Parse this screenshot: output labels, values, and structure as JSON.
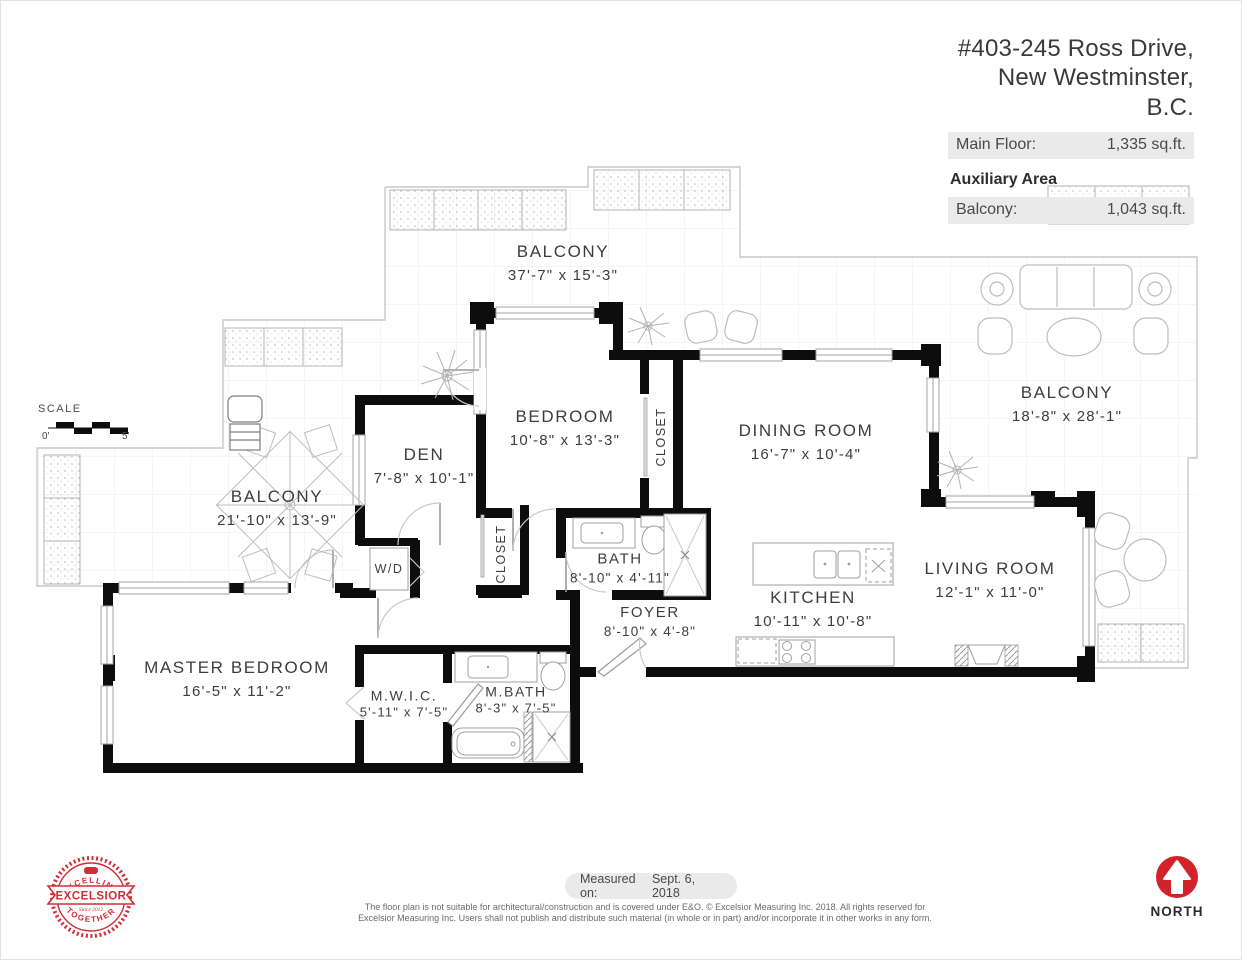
{
  "header": {
    "address_line1": "#403-245 Ross Drive,",
    "address_line2": "New Westminster, B.C.",
    "main_floor_label": "Main Floor:",
    "main_floor_value": "1,335 sq.ft.",
    "auxiliary_title": "Auxiliary Area",
    "balcony_label": "Balcony:",
    "balcony_value": "1,043 sq.ft."
  },
  "scale": {
    "label": "SCALE",
    "start": "0'",
    "end": "5'"
  },
  "rooms": {
    "balcony_top": {
      "name": "BALCONY",
      "dims": "37'-7\" x  15'-3\""
    },
    "bedroom": {
      "name": "BEDROOM",
      "dims": "10'-8\" x  13'-3\""
    },
    "den": {
      "name": "DEN",
      "dims": "7'-8\"  x  10'-1\""
    },
    "dining": {
      "name": "DINING ROOM",
      "dims": "16'-7\" x  10'-4\""
    },
    "balcony_right": {
      "name": "BALCONY",
      "dims": "18'-8\" x  28'-1\""
    },
    "balcony_left": {
      "name": "BALCONY",
      "dims": "21'-10\" x  13'-9\""
    },
    "living": {
      "name": "LIVING ROOM",
      "dims": "12'-1\" x  11'-0\""
    },
    "kitchen": {
      "name": "KITCHEN",
      "dims": "10'-11\" x  10'-8\""
    },
    "bath": {
      "name": "BATH",
      "dims": "8'-10\" x  4'-11\""
    },
    "foyer": {
      "name": "FOYER",
      "dims": "8'-10\" x  4'-8\""
    },
    "master": {
      "name": "MASTER BEDROOM",
      "dims": "16'-5\" x  11'-2\""
    },
    "mwic": {
      "name": "M.W.I.C.",
      "dims": "5'-11\" x  7'-5\""
    },
    "mbath": {
      "name": "M.BATH",
      "dims": "8'-3\" x  7'-5\""
    }
  },
  "labels": {
    "closet_bedroom": "CLOSET",
    "closet_hall": "CLOSET",
    "wd": "W/D"
  },
  "footer": {
    "measured_label": "Measured on:",
    "measured_date": "Sept. 6, 2018",
    "disclaimer_line1": "The floor plan is not suitable for architectural/construction and is covered under E&O. © Excelsior Measuring Inc. 2018. All rights reserved for",
    "disclaimer_line2": "Excelsior Measuring Inc. Users shall not publish and distribute such material (in whole or in part) and/or incorporate it in other works in any form.",
    "north_label": "NORTH"
  },
  "logo": {
    "top_arc": "EXCELLING",
    "name": "EXCELSIOR",
    "bottom_arc": "TOGETHER",
    "since": "Since 2012"
  },
  "colors": {
    "accent_red": "#d2232a",
    "wall_black": "#0d0d0d",
    "row_background": "#eaeaea"
  }
}
